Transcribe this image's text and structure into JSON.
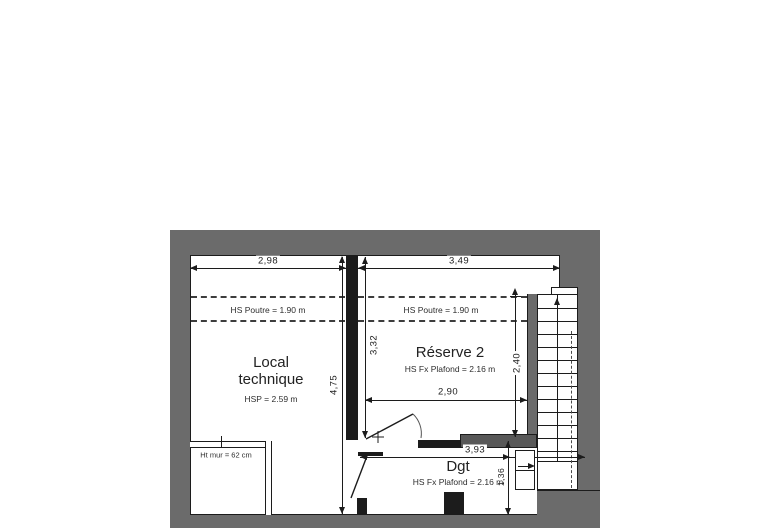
{
  "rooms": {
    "local_technique": {
      "label_line1": "Local",
      "label_line2": "technique",
      "sublabel": "HSP = 2.59 m"
    },
    "reserve2": {
      "label": "Réserve 2",
      "sublabel": "HS Fx Plafond = 2.16 m"
    },
    "dgt": {
      "label": "Dgt",
      "sublabel": "HS Fx Plafond = 2.16 m"
    }
  },
  "notes": {
    "beam_left": "HS Poutre = 1.90 m",
    "beam_right": "HS Poutre = 1.90 m",
    "low_wall": "Ht mur = 62 cm"
  },
  "dimensions": {
    "width_local": "2,98",
    "width_reserve": "3,49",
    "height_left": "4,75",
    "height_middle": "3,32",
    "height_reserve": "2,40",
    "width_reserve_inner": "2,90",
    "length_dgt": "3,93",
    "height_dgt": "1,36"
  },
  "icons": {
    "stair_direction": "up-arrow",
    "stair_entry": "right-arrow"
  },
  "colors": {
    "wall": "#6b6b6b",
    "line": "#1c1c1c",
    "floor": "#ffffff"
  }
}
